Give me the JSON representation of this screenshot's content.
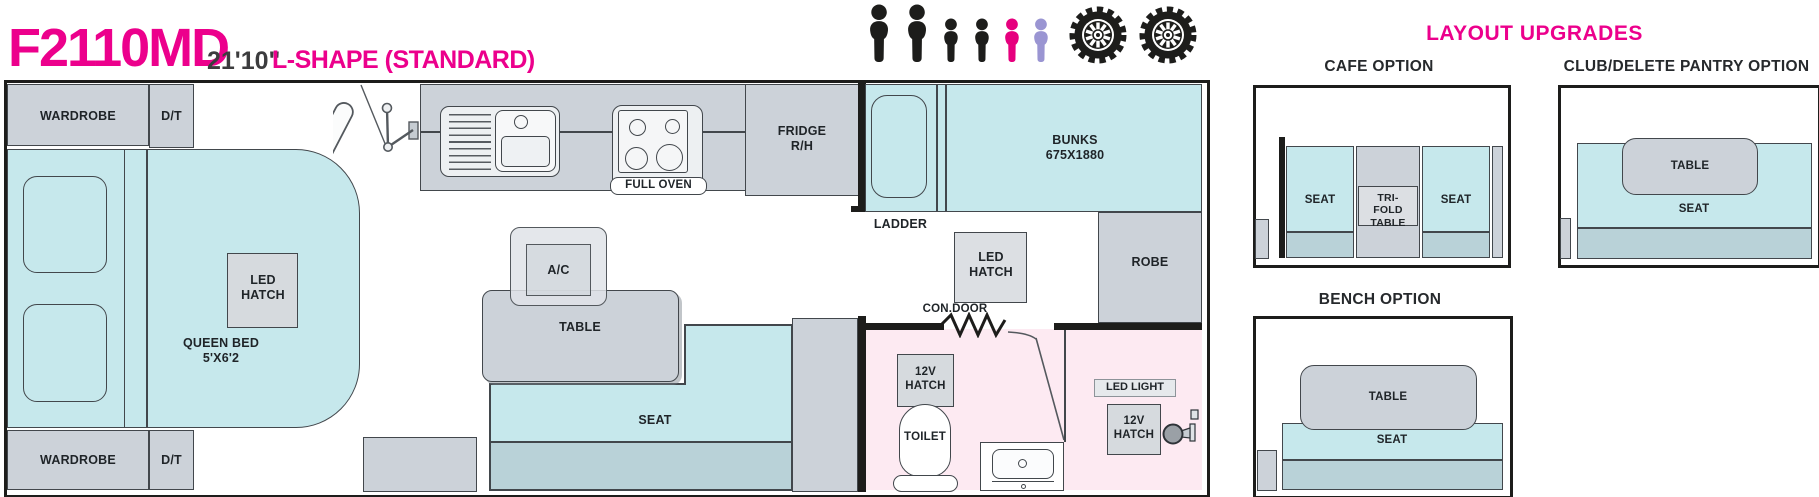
{
  "header": {
    "model": "F2110MD",
    "length": "21'10\"",
    "layout_name": "L-SHAPE (STANDARD)"
  },
  "capacity": {
    "icons": [
      {
        "type": "adult",
        "color": "#1d1d1b"
      },
      {
        "type": "adult",
        "color": "#1d1d1b"
      },
      {
        "type": "child",
        "color": "#1d1d1b"
      },
      {
        "type": "child",
        "color": "#1d1d1b"
      },
      {
        "type": "child",
        "color": "#e6007e"
      },
      {
        "type": "child",
        "color": "#9a95d2"
      }
    ],
    "wheel_icons": 2
  },
  "floorplan": {
    "wardrobe_top": "WARDROBE",
    "dt_top": "D/T",
    "queen_bed": "QUEEN BED",
    "queen_bed_size": "5'X6'2",
    "bed_led_hatch": "LED HATCH",
    "wardrobe_bottom": "WARDROBE",
    "dt_bottom": "D/T",
    "full_oven": "FULL OVEN",
    "fridge": "FRIDGE R/H",
    "bunks": "BUNKS",
    "bunks_size": "675X1880",
    "ladder": "LADDER",
    "ac": "A/C",
    "table": "TABLE",
    "seat": "SEAT",
    "hall_led_hatch": "LED HATCH",
    "robe": "ROBE",
    "con_door": "CON.DOOR",
    "toilet_12v_hatch": "12V HATCH",
    "toilet": "TOILET",
    "led_light": "LED LIGHT",
    "shower_12v_hatch": "12V HATCH"
  },
  "upgrades": {
    "title": "LAYOUT UPGRADES",
    "cafe": {
      "title": "CAFE OPTION",
      "seat_left": "SEAT",
      "table": "TRI-FOLD TABLE",
      "seat_right": "SEAT"
    },
    "club": {
      "title": "CLUB/DELETE PANTRY OPTION",
      "table": "TABLE",
      "seat": "SEAT"
    },
    "bench": {
      "title": "BENCH OPTION",
      "table": "TABLE",
      "seat": "SEAT"
    }
  },
  "colors": {
    "accent_magenta": "#ec008c",
    "cushion_teal": "#c6e8ec",
    "cushion_backrest": "#b9d2d8",
    "furniture_gray": "#ccd2d9",
    "hatch_gray": "#dcdfe3",
    "bathroom_pink": "#fdeaf2",
    "line_black": "#1d1d1b",
    "person_pink": "#e6007e",
    "person_purple": "#9a95d2"
  }
}
